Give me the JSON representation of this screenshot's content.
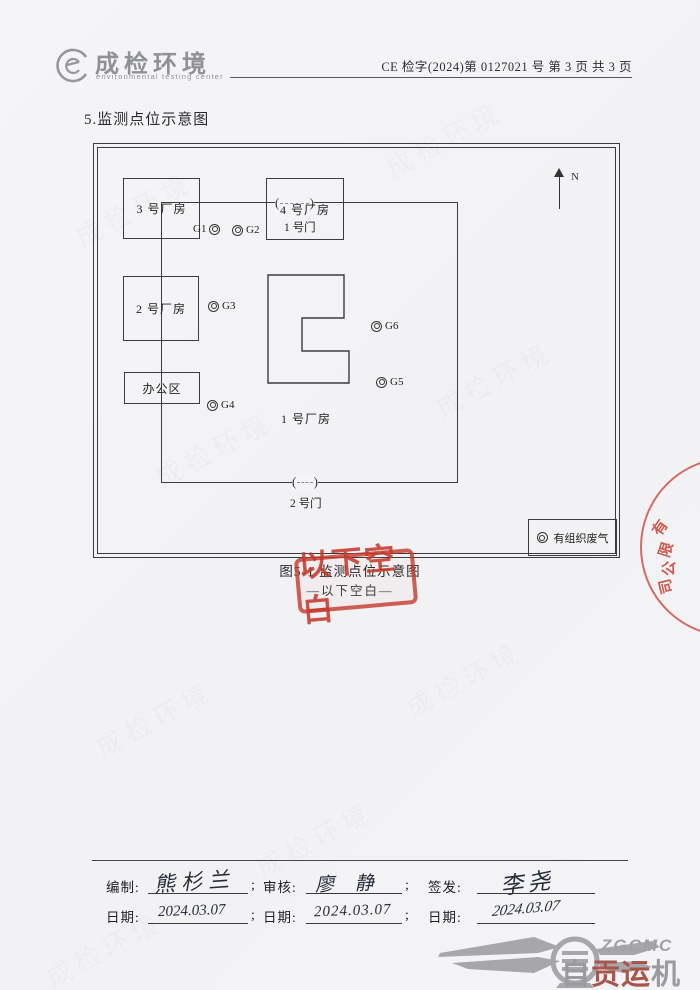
{
  "header": {
    "brand_cn": "成检环境",
    "brand_en": "environmental testing center",
    "doc_no": "CE 检字(2024)第 0127021 号 第 3 页 共 3 页"
  },
  "section": {
    "title": "5.监测点位示意图"
  },
  "diagram": {
    "north_label": "N",
    "gate1_label": "1 号门",
    "gate2_label": "2 号门",
    "buildings": {
      "b1": "1 号厂房",
      "b2": "2 号厂房",
      "b3": "3 号厂房",
      "b4": "4 号厂房",
      "office": "办公区"
    },
    "points": {
      "g1": "G1",
      "g2": "G2",
      "g3": "G3",
      "g4": "G4",
      "g5": "G5",
      "g6": "G6"
    },
    "legend_label": "有组织废气",
    "caption": "图5-1 监测点位示意图",
    "blank_note": "—以下空白—"
  },
  "stamps": {
    "blank_stamp": "以下空白",
    "side_stamp": [
      "有",
      "限",
      "公",
      "司"
    ]
  },
  "signatures": {
    "prepared_label": "编制:",
    "reviewed_label": "审核:",
    "issued_label": "签发:",
    "date_label": "日期:",
    "separator": ";",
    "prepared_sign": "熊杉兰",
    "reviewed_sign": "廖 静",
    "issued_sign": "李尧",
    "prepared_date": "2024.03.07",
    "reviewed_date": "2024.03.07",
    "issued_date": "2024.03.07"
  },
  "footer_logo": {
    "abbr": "ZGCMC",
    "name_c1": "自",
    "name_c2": "贡",
    "name_c3": "运",
    "name_c4": "机"
  },
  "watermark": "成检环境",
  "colors": {
    "stamp_red": "#c43a2e",
    "ink": "#262b38",
    "brand_gray": "#8f9195",
    "line": "#3b3b3d"
  }
}
